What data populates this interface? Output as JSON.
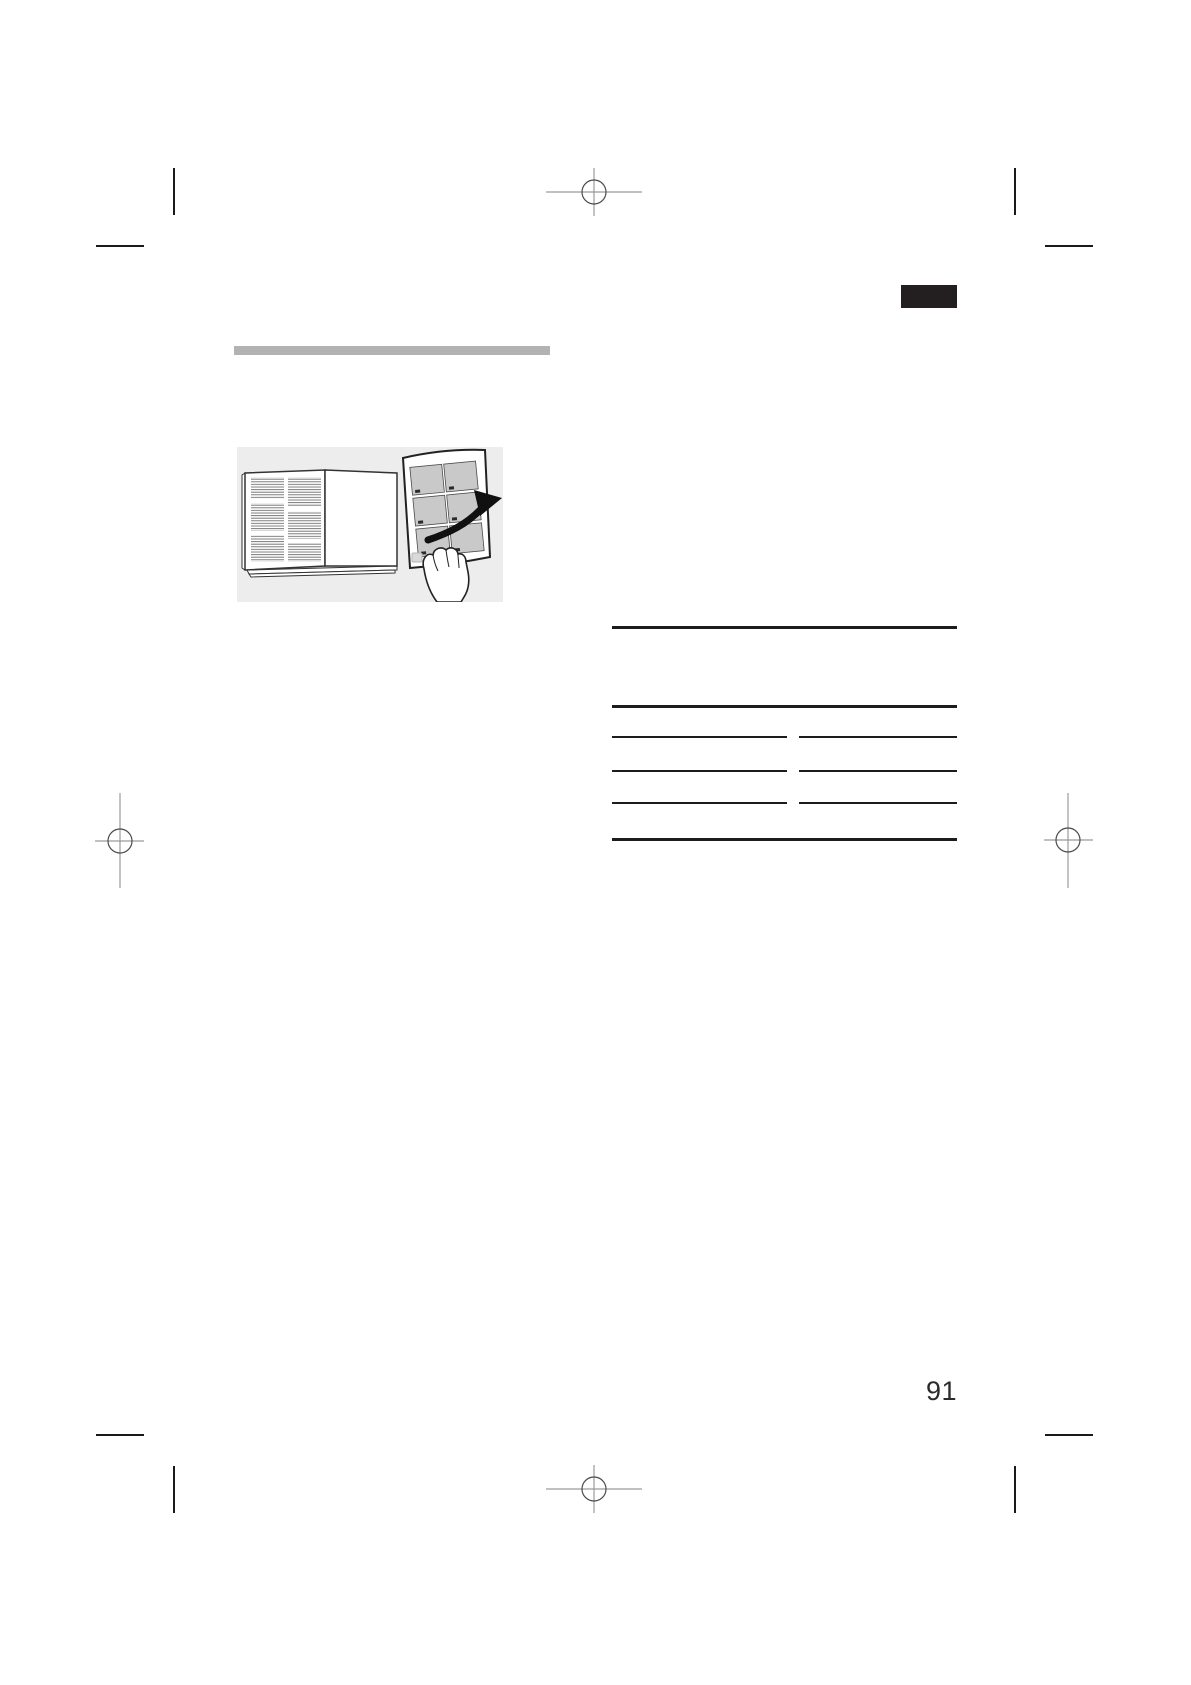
{
  "page": {
    "number": "91",
    "background": "#ffffff"
  },
  "header": {
    "section_tab_color": "#231f20",
    "title_bar_color": "#b2b2b2"
  },
  "illustration": {
    "subject": "hand removing ventilation filter panel from open appliance door",
    "background": "#ededed",
    "filter_grid": {
      "columns": 2,
      "rows": 3,
      "cell_color": "#c9c9c9"
    },
    "arrow_color": "#101010"
  },
  "reference_table": {
    "columns": 2,
    "full_width_rules": 3,
    "segmented_rule_rows": 3,
    "rule_color": "#1c1c1c",
    "cells_empty": true
  },
  "print_marks": {
    "registration_marks": [
      "top-center",
      "left-middle",
      "right-middle",
      "bottom-center"
    ],
    "corner_crop_marks": 8,
    "line_color": "#9b9b9b",
    "circle_color": "#4a4a4a",
    "crop_color": "#1a1a1a"
  },
  "icons": {
    "registration_mark": "crosshair-circle",
    "removal_arrow": "curved-arrow-right",
    "hand": "hand-grasping-filter"
  },
  "styles": {
    "tab_marker": "background:#231f20",
    "title_bar": "background:#b2b2b2"
  }
}
